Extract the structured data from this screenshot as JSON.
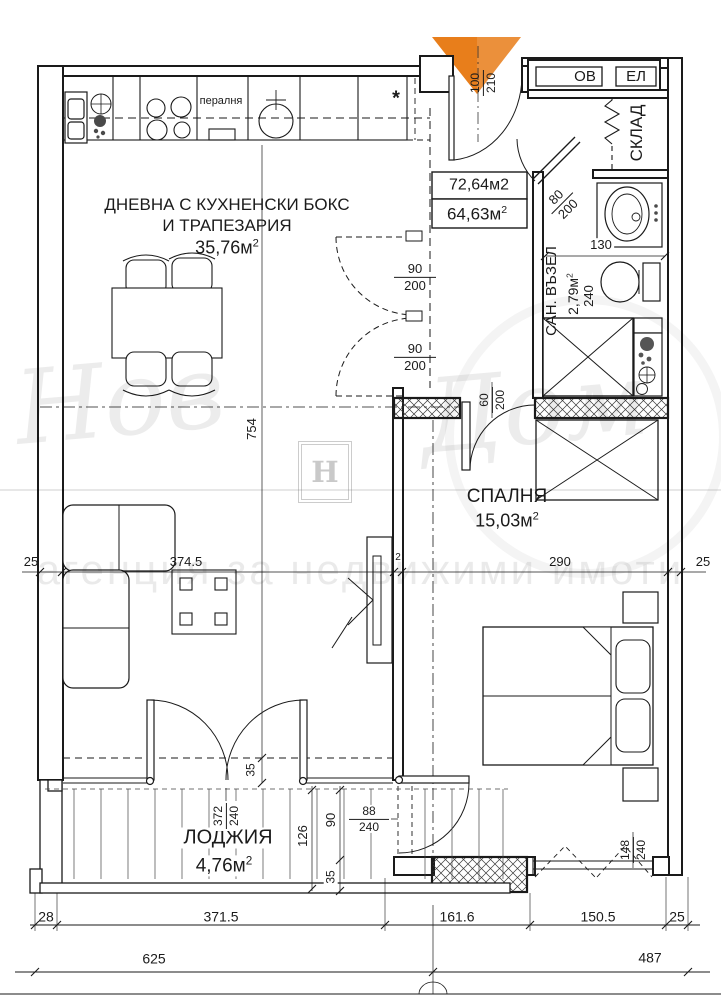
{
  "watermark": {
    "script_left": "Нов",
    "script_right": "Дом",
    "tagline": "агенция за недвижими имоти",
    "logo_letter": "Н"
  },
  "colors": {
    "entrance_marker": "#E87E1B",
    "line": "#1a1a1a"
  },
  "rooms": {
    "living": {
      "name_line1": "ДНЕВНА С КУХНЕНСКИ БОКС",
      "name_line2": "И ТРАПЕЗАРИЯ",
      "area": "35,76м",
      "area_sup": "2"
    },
    "bedroom": {
      "name": "СПАЛНЯ",
      "area": "15,03м",
      "area_sup": "2"
    },
    "loggia": {
      "name": "ЛОДЖИЯ",
      "area": "4,76м",
      "area_sup": "2"
    },
    "bathroom": {
      "name": "САН. ВЪЗЕЛ",
      "area": "2,79м",
      "area_sup": "2",
      "depth": "240",
      "width": "130"
    },
    "storage": {
      "name": "СКЛАД"
    },
    "shaft_left": "ОВ",
    "shaft_right": "ЕЛ"
  },
  "summary": {
    "total_area": "72,64м2",
    "net_area": "64,63м",
    "net_area_sup": "2"
  },
  "kitchen": {
    "washer_label": "пералня",
    "note_symbol": "*"
  },
  "doors": {
    "entrance": {
      "w": "100",
      "h": "210"
    },
    "living_door_top": {
      "w": "90",
      "h": "200"
    },
    "living_door_bottom": {
      "w": "90",
      "h": "200"
    },
    "bathroom_door": {
      "w": "80",
      "h": "200"
    },
    "bedroom_door": {
      "w": "60",
      "h": "200"
    },
    "loggia_door": {
      "w": "88",
      "h": "240"
    },
    "bedroom_window": {
      "w": "148",
      "h": "240"
    },
    "loggia_window": {
      "w": "372",
      "h": "240"
    }
  },
  "dims": {
    "living_height": "754",
    "living_width": "374.5",
    "partition": "2",
    "bedroom_width": "290",
    "wall_left": "25",
    "wall_right": "25",
    "loggia_offset": "35",
    "loggia_depth": "126",
    "loggia_seg1": "90",
    "loggia_seg2": "35",
    "bottom_row1": [
      "28",
      "371.5",
      "161.6",
      "150.5",
      "25"
    ],
    "bottom_row2": [
      "625",
      "487"
    ]
  }
}
